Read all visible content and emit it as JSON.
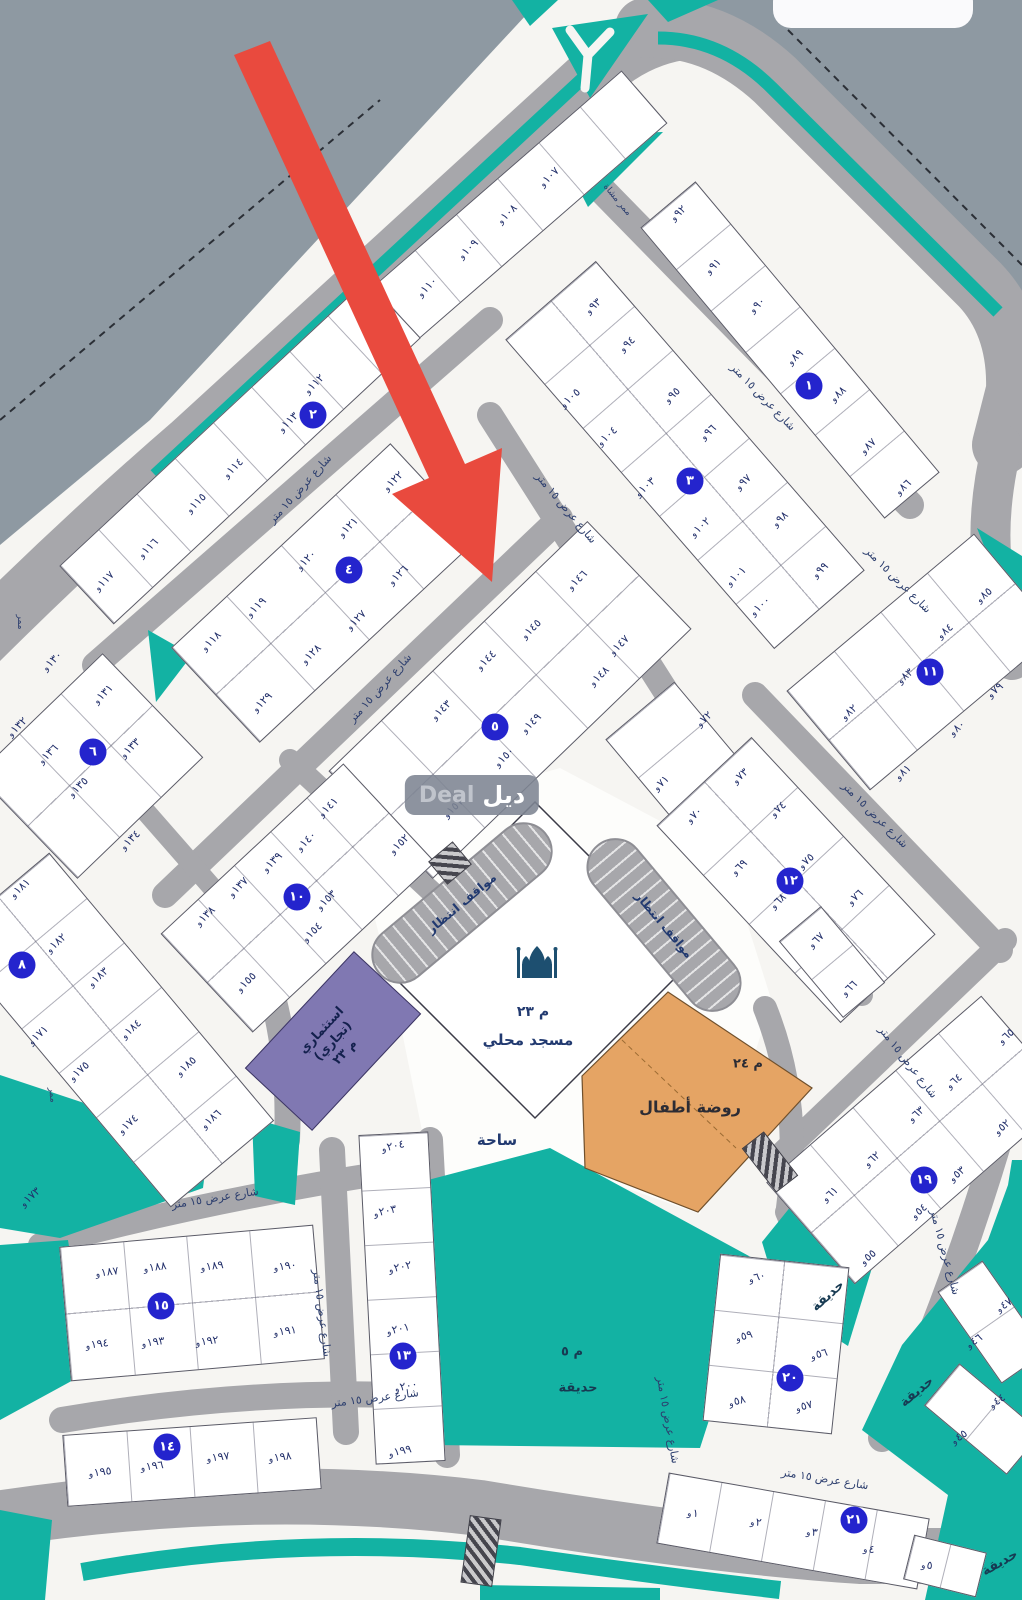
{
  "colors": {
    "road": "#a7a7ab",
    "outside": "#8e99a2",
    "teal": "#13b2a3",
    "block_fill": "#ffffff",
    "circle_blue": "#2424cd",
    "arrow_red": "#e94a3e",
    "kindergarten_orange": "#e5a464",
    "commercial_purple": "#8078b2",
    "plot_text": "#23306b"
  },
  "watermark": {
    "latin": "Deal",
    "arabic": "ديل"
  },
  "facilities": {
    "mosque": {
      "code": "م ٢٣",
      "name": "مسجد محلي"
    },
    "plaza": {
      "name": "ساحة"
    },
    "kindergarten": {
      "code": "م ٢٤",
      "name": "روضة أطفال"
    },
    "commercial": {
      "line1": "استثماري",
      "line2": "(تجاري)",
      "code": "م ٢٣"
    },
    "main_park": {
      "code": "م ٥",
      "name": "حديقة"
    },
    "parking_label": "مواقف انتظار",
    "street_name": "شارع عرض ١٥ متر"
  },
  "map": {
    "block_circles": [
      {
        "n": "١",
        "x": 809,
        "y": 386
      },
      {
        "n": "٢",
        "x": 313,
        "y": 415
      },
      {
        "n": "٣",
        "x": 690,
        "y": 481
      },
      {
        "n": "٤",
        "x": 349,
        "y": 570
      },
      {
        "n": "٥",
        "x": 495,
        "y": 727
      },
      {
        "n": "٦",
        "x": 93,
        "y": 752
      },
      {
        "n": "٨",
        "x": 22,
        "y": 965
      },
      {
        "n": "١٠",
        "x": 297,
        "y": 897
      },
      {
        "n": "١١",
        "x": 930,
        "y": 672
      },
      {
        "n": "١٢",
        "x": 790,
        "y": 881
      },
      {
        "n": "١٣",
        "x": 403,
        "y": 1356
      },
      {
        "n": "١٤",
        "x": 167,
        "y": 1447
      },
      {
        "n": "١٥",
        "x": 161,
        "y": 1306
      },
      {
        "n": "١٩",
        "x": 924,
        "y": 1180
      },
      {
        "n": "٢٠",
        "x": 790,
        "y": 1378
      },
      {
        "n": "٢١",
        "x": 854,
        "y": 1520
      }
    ],
    "blocks": [
      {
        "cx": 520,
        "cy": 205,
        "a": -41,
        "L": 330,
        "W": 70,
        "rows": 1,
        "cols": 6
      },
      {
        "cx": 240,
        "cy": 452,
        "a": -43,
        "L": 420,
        "W": 80,
        "rows": 1,
        "cols": 8
      },
      {
        "cx": 325,
        "cy": 593,
        "a": -43,
        "L": 300,
        "W": 130,
        "rows": 2,
        "cols": 4
      },
      {
        "cx": 790,
        "cy": 350,
        "a": 50,
        "L": 380,
        "W": 72,
        "rows": 1,
        "cols": 7
      },
      {
        "cx": 685,
        "cy": 455,
        "a": 49,
        "L": 410,
        "W": 120,
        "rows": 2,
        "cols": 7
      },
      {
        "cx": 510,
        "cy": 700,
        "a": -44,
        "L": 360,
        "W": 150,
        "rows": 2,
        "cols": 5
      },
      {
        "cx": 90,
        "cy": 766,
        "a": -44,
        "L": 175,
        "W": 145,
        "rows": 2,
        "cols": 3
      },
      {
        "cx": 298,
        "cy": 898,
        "a": -43,
        "L": 250,
        "W": 135,
        "rows": 2,
        "cols": 5
      },
      {
        "cx": 110,
        "cy": 1030,
        "a": 50,
        "L": 350,
        "W": 135,
        "rows": 2,
        "cols": 6
      },
      {
        "cx": 688,
        "cy": 768,
        "a": 50,
        "L": 150,
        "W": 90,
        "rows": 1,
        "cols": 3
      },
      {
        "cx": 922,
        "cy": 662,
        "a": -40,
        "L": 245,
        "W": 130,
        "rows": 2,
        "cols": 4
      },
      {
        "cx": 796,
        "cy": 880,
        "a": 47,
        "L": 270,
        "W": 130,
        "rows": 2,
        "cols": 4
      },
      {
        "cx": 832,
        "cy": 962,
        "a": 50,
        "L": 100,
        "W": 55,
        "rows": 1,
        "cols": 2
      },
      {
        "cx": 918,
        "cy": 1140,
        "a": -41,
        "L": 285,
        "W": 135,
        "rows": 2,
        "cols": 5
      },
      {
        "cx": 192,
        "cy": 1303,
        "a": -5,
        "L": 255,
        "W": 135,
        "rows": 2,
        "cols": 4
      },
      {
        "cx": 192,
        "cy": 1462,
        "a": -4,
        "L": 255,
        "W": 72,
        "rows": 1,
        "cols": 4
      },
      {
        "cx": 402,
        "cy": 1298,
        "a": 87,
        "L": 330,
        "W": 70,
        "rows": 1,
        "cols": 6
      },
      {
        "cx": 776,
        "cy": 1344,
        "a": 96,
        "L": 168,
        "W": 130,
        "rows": 2,
        "cols": 3
      },
      {
        "cx": 793,
        "cy": 1531,
        "a": 10,
        "L": 265,
        "W": 72,
        "rows": 1,
        "cols": 5
      },
      {
        "cx": 983,
        "cy": 1419,
        "a": 40,
        "L": 108,
        "W": 55,
        "rows": 1,
        "cols": 2
      },
      {
        "cx": 992,
        "cy": 1322,
        "a": 55,
        "L": 112,
        "W": 55,
        "rows": 1,
        "cols": 2
      },
      {
        "cx": 945,
        "cy": 1566,
        "a": 14,
        "L": 75,
        "W": 46,
        "rows": 1,
        "cols": 2
      }
    ],
    "plots": [
      {
        "t": "و١٠٧",
        "x": 549,
        "y": 177,
        "r": -44
      },
      {
        "t": "و١٠٨",
        "x": 507,
        "y": 214,
        "r": -44
      },
      {
        "t": "و١٠٩",
        "x": 468,
        "y": 249,
        "r": -44
      },
      {
        "t": "و١١٠",
        "x": 427,
        "y": 287,
        "r": -44
      },
      {
        "t": "و١١٢",
        "x": 314,
        "y": 384,
        "r": -44
      },
      {
        "t": "و١١٣",
        "x": 288,
        "y": 422,
        "r": -44
      },
      {
        "t": "و١١٤",
        "x": 233,
        "y": 468,
        "r": -44
      },
      {
        "t": "و١١٥",
        "x": 196,
        "y": 503,
        "r": -44
      },
      {
        "t": "و١١٦",
        "x": 148,
        "y": 548,
        "r": -44
      },
      {
        "t": "و١١٧",
        "x": 104,
        "y": 581,
        "r": -44
      },
      {
        "t": "و١٢٢",
        "x": 393,
        "y": 481,
        "r": -44
      },
      {
        "t": "و١٢١",
        "x": 348,
        "y": 527,
        "r": -44
      },
      {
        "t": "و١٢٠",
        "x": 306,
        "y": 560,
        "r": -44
      },
      {
        "t": "و١١٩",
        "x": 256,
        "y": 607,
        "r": -44
      },
      {
        "t": "و١١٨",
        "x": 211,
        "y": 641,
        "r": -44
      },
      {
        "t": "و١٢٦",
        "x": 398,
        "y": 575,
        "r": -44
      },
      {
        "t": "و١٢٧",
        "x": 356,
        "y": 620,
        "r": -44
      },
      {
        "t": "و١٢٨",
        "x": 311,
        "y": 654,
        "r": -44
      },
      {
        "t": "و١٢٩",
        "x": 262,
        "y": 702,
        "r": -44
      },
      {
        "t": "و٩٢",
        "x": 678,
        "y": 213,
        "r": -42
      },
      {
        "t": "و٩١",
        "x": 713,
        "y": 266,
        "r": -42
      },
      {
        "t": "و٩٠",
        "x": 757,
        "y": 305,
        "r": -42
      },
      {
        "t": "و٨٩",
        "x": 795,
        "y": 357,
        "r": -42
      },
      {
        "t": "و٨٨",
        "x": 838,
        "y": 394,
        "r": -42
      },
      {
        "t": "و٨٧",
        "x": 868,
        "y": 446,
        "r": -42
      },
      {
        "t": "و٨٦",
        "x": 903,
        "y": 487,
        "r": -42
      },
      {
        "t": "و٩٣",
        "x": 593,
        "y": 306,
        "r": -42
      },
      {
        "t": "و٩٤",
        "x": 627,
        "y": 344,
        "r": -42
      },
      {
        "t": "و٩٥",
        "x": 672,
        "y": 395,
        "r": -42
      },
      {
        "t": "و٩٦",
        "x": 708,
        "y": 432,
        "r": -42
      },
      {
        "t": "و٩٧",
        "x": 743,
        "y": 482,
        "r": -42
      },
      {
        "t": "و٩٨",
        "x": 780,
        "y": 519,
        "r": -42
      },
      {
        "t": "و٩٩",
        "x": 820,
        "y": 570,
        "r": -42
      },
      {
        "t": "و١٠٥",
        "x": 570,
        "y": 398,
        "r": -42
      },
      {
        "t": "و١٠٤",
        "x": 607,
        "y": 436,
        "r": -42
      },
      {
        "t": "و١٠٣",
        "x": 645,
        "y": 487,
        "r": -42
      },
      {
        "t": "و١٠٢",
        "x": 700,
        "y": 527,
        "r": -42
      },
      {
        "t": "و١٠١",
        "x": 736,
        "y": 576,
        "r": -42
      },
      {
        "t": "و١٠٠",
        "x": 760,
        "y": 606,
        "r": -42
      },
      {
        "t": "و١٤٦",
        "x": 577,
        "y": 580,
        "r": -44
      },
      {
        "t": "و١٤٥",
        "x": 531,
        "y": 629,
        "r": -44
      },
      {
        "t": "و١٤٤",
        "x": 486,
        "y": 660,
        "r": -44
      },
      {
        "t": "و١٤٣",
        "x": 441,
        "y": 710,
        "r": -44
      },
      {
        "t": "و١٤٧",
        "x": 619,
        "y": 645,
        "r": -44
      },
      {
        "t": "و١٤٨",
        "x": 599,
        "y": 676,
        "r": -44
      },
      {
        "t": "و١٤٩",
        "x": 531,
        "y": 723,
        "r": -44
      },
      {
        "t": "و١٥٠",
        "x": 504,
        "y": 757,
        "r": -44
      },
      {
        "t": "و١٥١",
        "x": 453,
        "y": 808,
        "r": -44
      },
      {
        "t": "و١٥٢",
        "x": 399,
        "y": 844,
        "r": -44
      },
      {
        "t": "و١٣٠",
        "x": 52,
        "y": 661,
        "r": -44
      },
      {
        "t": "و١٣١",
        "x": 103,
        "y": 694,
        "r": -44
      },
      {
        "t": "و١٣٢",
        "x": 17,
        "y": 727,
        "r": -44
      },
      {
        "t": "و١٣٣",
        "x": 130,
        "y": 748,
        "r": -44
      },
      {
        "t": "و١٣٦",
        "x": 48,
        "y": 754,
        "r": -44
      },
      {
        "t": "و١٣٥",
        "x": 78,
        "y": 787,
        "r": -44
      },
      {
        "t": "و١٣٤",
        "x": 130,
        "y": 840,
        "r": -44
      },
      {
        "t": "و١٤١",
        "x": 328,
        "y": 807,
        "r": -44
      },
      {
        "t": "و١٤٠",
        "x": 306,
        "y": 841,
        "r": -44
      },
      {
        "t": "و١٣٩",
        "x": 272,
        "y": 862,
        "r": -44
      },
      {
        "t": "و١٣٧",
        "x": 238,
        "y": 887,
        "r": -44
      },
      {
        "t": "و١٣٨",
        "x": 205,
        "y": 916,
        "r": -44
      },
      {
        "t": "و١٥٣",
        "x": 326,
        "y": 900,
        "r": -44
      },
      {
        "t": "و١٥٤",
        "x": 312,
        "y": 932,
        "r": -44
      },
      {
        "t": "و١٥٥",
        "x": 246,
        "y": 982,
        "r": -44
      },
      {
        "t": "و١٨١",
        "x": 20,
        "y": 888,
        "r": -42
      },
      {
        "t": "و١٨٢",
        "x": 56,
        "y": 943,
        "r": -42
      },
      {
        "t": "و١٨٣",
        "x": 98,
        "y": 977,
        "r": -42
      },
      {
        "t": "و١٨٤",
        "x": 131,
        "y": 1029,
        "r": -42
      },
      {
        "t": "و١٨٥",
        "x": 186,
        "y": 1066,
        "r": -42
      },
      {
        "t": "و١٨٦",
        "x": 211,
        "y": 1119,
        "r": -42
      },
      {
        "t": "و١٧١",
        "x": 38,
        "y": 1035,
        "r": -42
      },
      {
        "t": "و١٧٥",
        "x": 79,
        "y": 1071,
        "r": -42
      },
      {
        "t": "و١٧٤",
        "x": 128,
        "y": 1124,
        "r": -42
      },
      {
        "t": "و١٧٣",
        "x": 30,
        "y": 1197,
        "r": -42
      },
      {
        "t": "و٧٢",
        "x": 704,
        "y": 719,
        "r": -42
      },
      {
        "t": "و٧١",
        "x": 661,
        "y": 783,
        "r": -42
      },
      {
        "t": "و٧٠",
        "x": 694,
        "y": 815,
        "r": -42
      },
      {
        "t": "و٨٥",
        "x": 984,
        "y": 595,
        "r": -40
      },
      {
        "t": "و٨٤",
        "x": 945,
        "y": 631,
        "r": -40
      },
      {
        "t": "و٨٣",
        "x": 905,
        "y": 676,
        "r": -40
      },
      {
        "t": "و٨٢",
        "x": 849,
        "y": 712,
        "r": -40
      },
      {
        "t": "و٧٩",
        "x": 995,
        "y": 690,
        "r": -40
      },
      {
        "t": "و٨٠",
        "x": 957,
        "y": 728,
        "r": -40
      },
      {
        "t": "و٨١",
        "x": 903,
        "y": 772,
        "r": -40
      },
      {
        "t": "و٧٣",
        "x": 740,
        "y": 776,
        "r": -42
      },
      {
        "t": "و٧٤",
        "x": 778,
        "y": 809,
        "r": -42
      },
      {
        "t": "و٧٥",
        "x": 806,
        "y": 861,
        "r": -42
      },
      {
        "t": "و٧٦",
        "x": 855,
        "y": 897,
        "r": -42
      },
      {
        "t": "و٦٩",
        "x": 739,
        "y": 867,
        "r": -42
      },
      {
        "t": "و٦٨",
        "x": 778,
        "y": 901,
        "r": -42
      },
      {
        "t": "و٦٧",
        "x": 816,
        "y": 940,
        "r": -42
      },
      {
        "t": "و٦٦",
        "x": 849,
        "y": 988,
        "r": -42
      },
      {
        "t": "و٦١",
        "x": 830,
        "y": 1194,
        "r": -40
      },
      {
        "t": "و٦٢",
        "x": 872,
        "y": 1159,
        "r": -40
      },
      {
        "t": "و٦٣",
        "x": 916,
        "y": 1114,
        "r": -40
      },
      {
        "t": "و٦٤",
        "x": 954,
        "y": 1081,
        "r": -40
      },
      {
        "t": "و٦٥",
        "x": 1006,
        "y": 1036,
        "r": -40
      },
      {
        "t": "و٥٥",
        "x": 868,
        "y": 1257,
        "r": -40
      },
      {
        "t": "و٥٤",
        "x": 919,
        "y": 1211,
        "r": -40
      },
      {
        "t": "و٥٣",
        "x": 957,
        "y": 1174,
        "r": -40
      },
      {
        "t": "و٥٢",
        "x": 1002,
        "y": 1127,
        "r": -40
      },
      {
        "t": "و٦٠",
        "x": 757,
        "y": 1277,
        "r": -15
      },
      {
        "t": "و٥٩",
        "x": 744,
        "y": 1336,
        "r": -15
      },
      {
        "t": "و٥٨",
        "x": 737,
        "y": 1401,
        "r": -15
      },
      {
        "t": "و٥٦",
        "x": 819,
        "y": 1354,
        "r": -15
      },
      {
        "t": "و٥٧",
        "x": 804,
        "y": 1406,
        "r": -15
      },
      {
        "t": "و١٨٧",
        "x": 107,
        "y": 1272,
        "r": -7
      },
      {
        "t": "و١٨٨",
        "x": 155,
        "y": 1267,
        "r": -7
      },
      {
        "t": "و١٨٩",
        "x": 212,
        "y": 1266,
        "r": -7
      },
      {
        "t": "و١٩٠",
        "x": 285,
        "y": 1266,
        "r": -7
      },
      {
        "t": "و١٩١",
        "x": 285,
        "y": 1331,
        "r": -7
      },
      {
        "t": "و١٩٢",
        "x": 207,
        "y": 1341,
        "r": -7
      },
      {
        "t": "و١٩٣",
        "x": 153,
        "y": 1342,
        "r": -7
      },
      {
        "t": "و١٩٤",
        "x": 97,
        "y": 1344,
        "r": -7
      },
      {
        "t": "و١٩٥",
        "x": 100,
        "y": 1472,
        "r": -7
      },
      {
        "t": "و١٩٦",
        "x": 152,
        "y": 1466,
        "r": -7
      },
      {
        "t": "و١٩٧",
        "x": 218,
        "y": 1457,
        "r": -7
      },
      {
        "t": "و١٩٨",
        "x": 280,
        "y": 1457,
        "r": -7
      },
      {
        "t": "و٢٠٤",
        "x": 393,
        "y": 1146,
        "r": -12
      },
      {
        "t": "و٢٠٣",
        "x": 385,
        "y": 1211,
        "r": -12
      },
      {
        "t": "و٢٠٢",
        "x": 400,
        "y": 1267,
        "r": -12
      },
      {
        "t": "و٢٠١",
        "x": 398,
        "y": 1329,
        "r": -12
      },
      {
        "t": "و٢٠٠",
        "x": 406,
        "y": 1386,
        "r": -12
      },
      {
        "t": "و١٩٩",
        "x": 400,
        "y": 1451,
        "r": -12
      },
      {
        "t": "و١",
        "x": 693,
        "y": 1513,
        "r": 6
      },
      {
        "t": "و٢",
        "x": 756,
        "y": 1522,
        "r": 6
      },
      {
        "t": "و٣",
        "x": 812,
        "y": 1532,
        "r": 6
      },
      {
        "t": "و٤",
        "x": 869,
        "y": 1549,
        "r": 6
      },
      {
        "t": "و٥",
        "x": 927,
        "y": 1565,
        "r": 6
      },
      {
        "t": "و٤٤",
        "x": 997,
        "y": 1401,
        "r": -35
      },
      {
        "t": "و٤٥",
        "x": 959,
        "y": 1437,
        "r": -35
      },
      {
        "t": "و٤٧",
        "x": 1004,
        "y": 1305,
        "r": -35
      },
      {
        "t": "و٤٦",
        "x": 974,
        "y": 1341,
        "r": -35
      }
    ],
    "street_labels": [
      {
        "t": "شارع عرض ١٥ متر",
        "x": 300,
        "y": 489,
        "r": -48
      },
      {
        "t": "شارع عرض ١٥ متر",
        "x": 380,
        "y": 688,
        "r": -48
      },
      {
        "t": "شارع عرض ١٥ متر",
        "x": 763,
        "y": 397,
        "r": 46
      },
      {
        "t": "شارع عرض ١٥ متر",
        "x": 566,
        "y": 508,
        "r": 50
      },
      {
        "t": "شارع عرض ١٥ متر",
        "x": 898,
        "y": 580,
        "r": 45
      },
      {
        "t": "شارع عرض ١٥ متر",
        "x": 875,
        "y": 815,
        "r": 45
      },
      {
        "t": "شارع عرض ١٥ متر",
        "x": 908,
        "y": 1062,
        "r": 52
      },
      {
        "t": "شارع عرض ١٥ متر",
        "x": 215,
        "y": 1198,
        "r": -9
      },
      {
        "t": "شارع عرض ١٥ متر",
        "x": 375,
        "y": 1398,
        "r": -7
      },
      {
        "t": "شارع عرض ١٥ متر",
        "x": 322,
        "y": 1313,
        "r": 83
      },
      {
        "t": "شارع عرض ١٥ متر",
        "x": 668,
        "y": 1420,
        "r": 80
      },
      {
        "t": "شارع عرض ١٥ متر",
        "x": 825,
        "y": 1479,
        "r": 9
      },
      {
        "t": "شارع عرض ١٥ متر",
        "x": 945,
        "y": 1252,
        "r": 75
      }
    ],
    "park_labels": [
      {
        "t": "م ٥",
        "x": 572,
        "y": 1352,
        "r": 0
      },
      {
        "t": "حديقة",
        "x": 578,
        "y": 1388,
        "r": 0
      },
      {
        "t": "حديقة",
        "x": 828,
        "y": 1296,
        "r": -42
      },
      {
        "t": "حديقة",
        "x": 917,
        "y": 1392,
        "r": -40
      },
      {
        "t": "حديقة",
        "x": 1000,
        "y": 1563,
        "r": -30
      }
    ],
    "passages": [
      {
        "t": "ممر",
        "x": 20,
        "y": 622,
        "r": 90
      },
      {
        "t": "ممر",
        "x": 52,
        "y": 1095,
        "r": 85
      },
      {
        "t": "ممر مشاة",
        "x": 617,
        "y": 200,
        "r": 50
      }
    ]
  }
}
